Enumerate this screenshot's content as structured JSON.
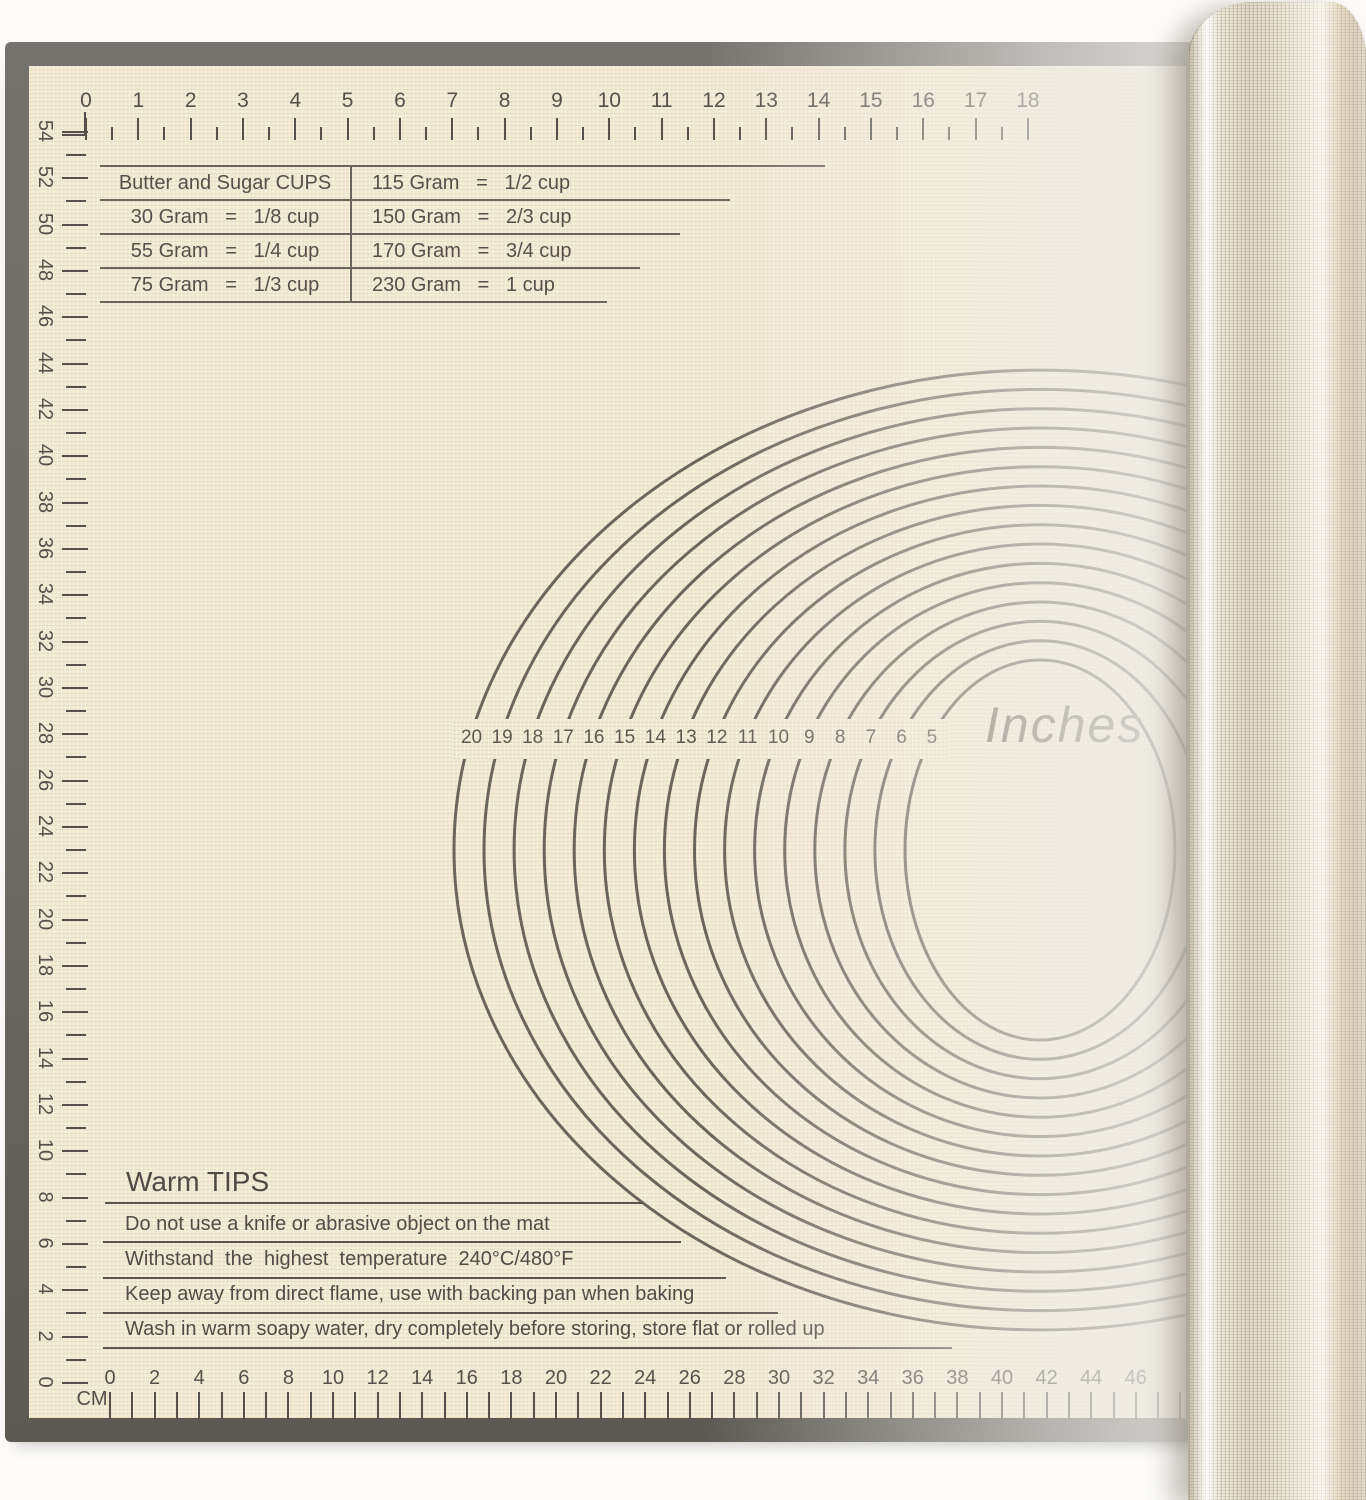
{
  "photo": {
    "description": "Beige silicone pastry baking mat with printed measurements, right side rolled up"
  },
  "colors": {
    "background": "#fdfcfa",
    "mat_surface": "#f2e9d1",
    "mat_border": "#6d6b65",
    "print": "#55514a",
    "circle_line": "#6b665b",
    "roll_fabric": "#e9e3d4"
  },
  "top_ruler": {
    "unit": "inches",
    "labels": [
      "0",
      "1",
      "2",
      "3",
      "4",
      "5",
      "6",
      "7",
      "8",
      "9",
      "10",
      "11",
      "12",
      "13",
      "14",
      "15",
      "16",
      "17",
      "18"
    ]
  },
  "left_ruler": {
    "unit": "cm",
    "labels": [
      "54",
      "52",
      "50",
      "48",
      "46",
      "44",
      "42",
      "40",
      "38",
      "36",
      "34",
      "32",
      "30",
      "28",
      "26",
      "24",
      "22",
      "20",
      "18",
      "16",
      "14",
      "12",
      "10",
      "8",
      "6",
      "4",
      "2",
      "0"
    ]
  },
  "bottom_ruler": {
    "unit_label": "CM",
    "labels": [
      "0",
      "2",
      "4",
      "6",
      "8",
      "10",
      "12",
      "14",
      "16",
      "18",
      "20",
      "22",
      "24",
      "26",
      "28",
      "30",
      "32",
      "34",
      "36",
      "38",
      "40",
      "42",
      "44",
      "46"
    ]
  },
  "conversion_table": {
    "header": "Butter and Sugar CUPS",
    "left_rows": [
      "30 Gram   =   1/8 cup",
      "55 Gram   =   1/4 cup",
      "75 Gram   =   1/3 cup"
    ],
    "right_rows": [
      "115 Gram   =   1/2 cup",
      "150 Gram   =   2/3 cup",
      "170 Gram   =   3/4 cup",
      "230 Gram   =   1 cup"
    ]
  },
  "circle_guide": {
    "diameter_labels": [
      "20",
      "19",
      "18",
      "17",
      "16",
      "15",
      "14",
      "13",
      "12",
      "11",
      "10",
      "9",
      "8",
      "7",
      "6",
      "5"
    ],
    "unit_text": "Inches"
  },
  "warm_tips": {
    "title": "Warm TIPS",
    "items": [
      "Do not use a knife or abrasive object on the mat",
      "Withstand  the  highest  temperature  240°C/480°F",
      "Keep away from direct flame, use with backing pan when baking",
      "Wash in warm soapy water, dry completely before storing, store flat or rolled up"
    ]
  }
}
